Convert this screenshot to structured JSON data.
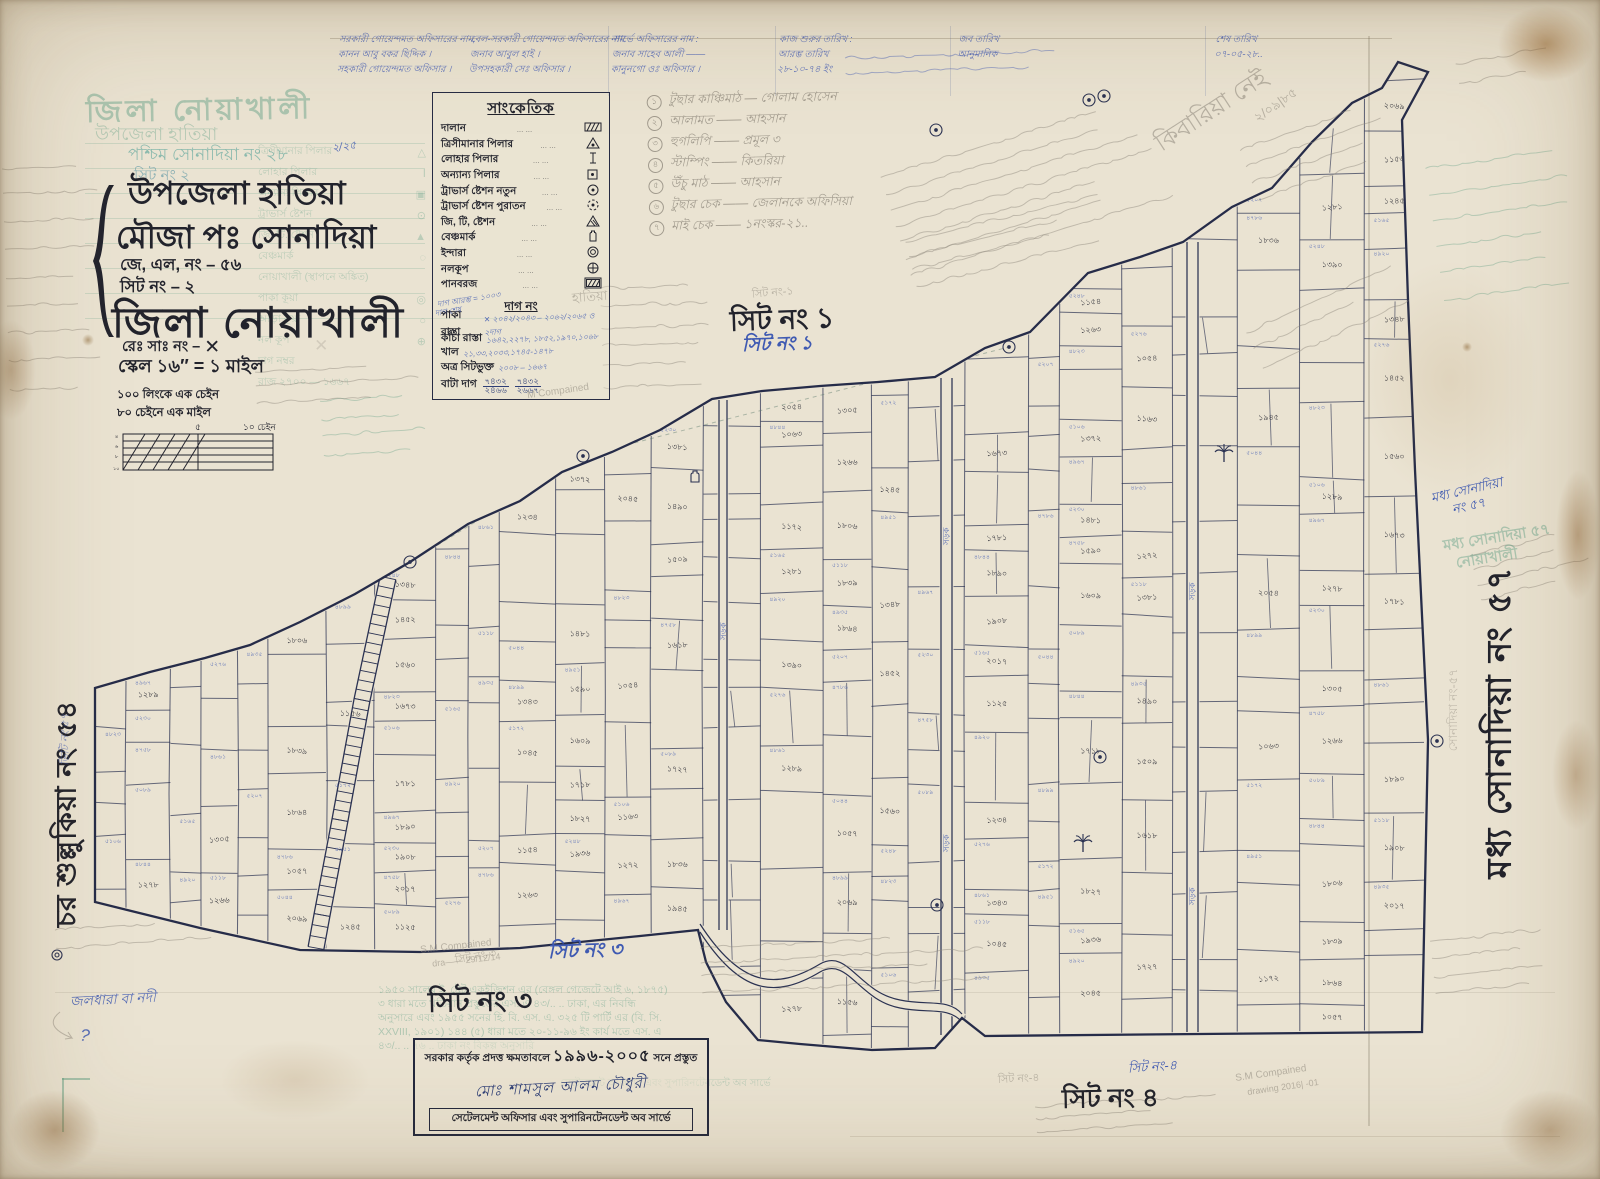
{
  "colors": {
    "paper": "#eae3d2",
    "ink": "#2b3252",
    "black": "#22232c",
    "blue_pen": "#3f5ab2",
    "green_stamp": "#5f9f85",
    "pencil": "#8e887c"
  },
  "title_block": {
    "ghost_district": "জিলা নোয়াখালী",
    "ghost_upazila": "উপজেলা হাতিয়া",
    "ghost_mouza": "পশ্চিম সোনাদিয়া নং ২৮",
    "ghost_sheet": "সিট নং ২",
    "upazila": "উপজেলা হাতিয়া",
    "mouza": "মৌজা  পঃ সোনাদিয়া",
    "jl_no": "জে, এল, নং – ৫৬",
    "sheet_no": "সিট নং – ২",
    "district": "জিলা  নোয়াখালী",
    "reg_no": "রেঃ সাঃ নং –",
    "reg_no_mark": "✕",
    "scale": "স্কেল ১৬″ = ১ মাইল",
    "chain_note1": "১০০ লিংকে এক চেইন",
    "chain_note2": "৮০ চেইনে এক মাইল"
  },
  "scalebar": {
    "mid": "৫",
    "right": "১০ চেইন"
  },
  "legend": {
    "title": "সাংকেতিক",
    "dots": "...      ...",
    "items": [
      {
        "label": "দালান",
        "symbol": "hatched-rect"
      },
      {
        "label": "ত্রিসীমানার পিলার",
        "symbol": "triangle-dot"
      },
      {
        "label": "লোহার পিলার",
        "symbol": "iron-pillar"
      },
      {
        "label": "অন্যান্য পিলার",
        "symbol": "square-dot"
      },
      {
        "label": "ট্রাভার্স ষ্টেশন নতুন",
        "symbol": "circle-dot"
      },
      {
        "label": "ট্রাভার্স ষ্টেশন পুরাতন",
        "symbol": "circle-dashed"
      },
      {
        "label": "জি, টি, ষ্টেশন",
        "symbol": "triangle-hatched"
      },
      {
        "label": "বেঞ্চমার্ক",
        "symbol": "benchmark"
      },
      {
        "label": "ইন্দারা",
        "symbol": "double-circle"
      },
      {
        "label": "নলকূপ",
        "symbol": "circle-cross"
      },
      {
        "label": "পানবরজ",
        "symbol": "hatched-rect-border"
      }
    ],
    "dag_heading": "দাগ নং",
    "dag_rows": [
      {
        "label": "পাকা রাস্তা",
        "value": "✕ ২০৪২/২০৪৩ – ২০৬২/২০৬৫ ও ২দাগ"
      },
      {
        "label": "কাঁচা রাস্তা",
        "value": "১৬৪২,২২৭৮, ১৮৫২,১৯৭০,১০৬৮"
      },
      {
        "label": "খাল",
        "value": "২১,৩৩,২০৩৩,১৭৪৫-১৪৭৮"
      },
      {
        "label": "অত্র সিটভুক্ত",
        "value": "২০০৮ – ১৬৬৭"
      }
    ],
    "bata_label": "বাটা দাগ",
    "bata_fracs": [
      {
        "nu": "৭৪৩২",
        "de": "২৪৬৬"
      },
      {
        "nu": "৭৪৩২",
        "de": "২৬৬৭"
      }
    ],
    "blue_note1": "দাগ আরম্ভ = ১০০৩",
    "blue_note2": "দাগ শেষ"
  },
  "top_table": {
    "columns": [
      {
        "x": 338,
        "lines": [
          "সরকারী গোয়েন্দমত অফিসারের নাম,",
          "কানন আবু বকর ছিদ্দিক ।",
          "সহকারী গোয়েন্দমত অফিসার ।"
        ]
      },
      {
        "x": 470,
        "lines": [
          "বেল-সরকারী গোয়েন্দমত অফিসারের নাম",
          "জনাব আবুল হাই ।",
          "উপসহকারী সেঃ অফিসার ।"
        ]
      },
      {
        "x": 612,
        "lines": [
          "সার্ভে অফিসারের নাম :",
          "জনাব সাহেব আলী ——",
          "কানুনগো ওঃ অফিসার ।"
        ]
      },
      {
        "x": 778,
        "lines": [
          "কাজ শুরুর তারিখ :",
          "আরম্ভ তারিখ",
          "২৮-১০-৭৪ ইং"
        ]
      },
      {
        "x": 958,
        "lines": [
          "",
          "জব তারিখ",
          "আনুমানিক"
        ]
      },
      {
        "x": 1215,
        "lines": [
          "",
          "শেষ তারিখ",
          "০৭-০৫-২৮.."
        ]
      }
    ]
  },
  "numbered_list": {
    "items": [
      "টুছার কাঞ্চিমাঠ — গোলাম হোসেন",
      "আলামত —— আহসান",
      "হুগলিপি —— প্রমূল ৩",
      "স্টাম্পিং —— কিতরিয়া",
      "উঁচু মাঠ —— আহসান",
      "টুছার চেক —— জেলানকে অফিসিয়া",
      "মাই চেক —— ১নংস্কর-২১.."
    ]
  },
  "sheet_labels": {
    "s1_black": "সিট নং ১",
    "s1_blue": "সিট নং ১",
    "s1_pencil": "সিট নং-১",
    "s3_black": "সিট নং ৩",
    "s3_blue": "সিট নং ৩",
    "s4_black": "সিট নং ৪",
    "s4_blue": "সিট নং-৪",
    "s4_pencil": "সিট নং-৪"
  },
  "margins": {
    "left_black": "চর শুল্লুকিয়া নং ৫৪",
    "left_blue": "ভিটি নং ৫৭",
    "right_black": "মধ্য সোনাদিয়া নং ৫৭",
    "right_blue1": "মধ্য সোনাদিয়া",
    "right_blue2": "নং ৫৭",
    "right_green1": "মধ্য সোনাদিয়া ৫৭",
    "right_green2": "নোয়াখালী",
    "right_pencil": "সোনাদিয়া নং-৫৭"
  },
  "stamp_box": {
    "line1_pre": "সরকার কর্তৃক প্রদত্ত ক্ষমতাবলে",
    "years": "১৯৯৬-২০০৫",
    "line1_post": "সনে প্রস্তুত",
    "signature": "মোঃ শামসুল আলম  চৌধুরী",
    "line2": "সেটেলমেন্ট অফিসার এবং সুপারিনটেনডেন্ট অব সার্ভে"
  },
  "ghost": {
    "legend_items": [
      {
        "label": "ত্রিসীমানার পিলার",
        "sym": "△"
      },
      {
        "label": "লোহার পিলার",
        "sym": "Ⅰ"
      },
      {
        "label": "অন্যান্য পিলার",
        "sym": "▣"
      },
      {
        "label": "ট্রাভার্স ষ্টেশন",
        "sym": "⊙"
      },
      {
        "label": "জি. টি. ষ্টেশন",
        "sym": "▲"
      },
      {
        "label": "বেঞ্চমার্ক",
        "sym": "◌"
      },
      {
        "label": "নোয়াখালী (স্থাপনে অঙ্কিত)",
        "sym": ""
      },
      {
        "label": "পাকা কূয়া",
        "sym": "◎"
      },
      {
        "label": "আড়া কূয়া",
        "sym": "○"
      },
      {
        "label": "নল কূপ",
        "sym": "⊕"
      },
      {
        "label": "দাগ নম্বর",
        "sym": ""
      },
      {
        "label": "রাজ  ২৭০০ — ১৬৬৭",
        "sym": ""
      }
    ],
    "stamp_paragraph": [
      "১৯৫০ সালের ই. ষ্টেট একুইজিশন এর (বেঙ্গল গেজেটে আই ৬, ১৮৭৫)",
      "৩ ধারা মতে খতিয়ান প্রস্তুতের এস. এ ৪৩/.. .. ঢাকা, এর নিবন্ধি",
      "অনুসারে এবং ১৯৫৫ সনের হি. বি. এস. এ. ৩২৫ টি পার্টি এর (বি. সি.",
      "XXVIII, ১৯০১) ১৪৪ (৫) ধারা মতে ২০-১১-৯৬ ইং কার্য মতে এস. এ",
      "৪৩/.. .. ৭৬ .. ঢাকা নং বিকল্প অনুসারি"
    ],
    "footer_echo": "সেটেলমেন্ট অফিসার এবং সুপারিনটেনডেন্ট অব সার্ভে"
  },
  "map": {
    "road_label": "সড়ক",
    "parcels": {
      "black": [
        "১২৮৯",
        "১২৭৮",
        "১৩০৫",
        "১২৬৬",
        "১৮০৬",
        "১৮৩৯",
        "১৮৬৪",
        "১০৫৭",
        "২০৬৯",
        "১১৫৬",
        "১২৪৫",
        "১৩৪৮",
        "১৪৫২",
        "১৫৬০",
        "১৬৭৩",
        "১৭৮১",
        "১৮৯০",
        "১৯০৮",
        "২০১৭",
        "১১২৫",
        "১২৩৪",
        "১৩৪৩",
        "১০৪৫",
        "১১৫৪",
        "১২৬৩",
        "১৩৭২",
        "১৪৮১",
        "১৫৯০",
        "১৬০৯",
        "১৭১৮",
        "১৮২৭",
        "১৯৩৬",
        "২০৪৫",
        "১০৫৪",
        "১১৬৩",
        "১২৭২",
        "১৩৮১",
        "১৪৯০",
        "১৫০৯",
        "১৬১৮",
        "১৭২৭",
        "১৮৩৬",
        "১৯৪৫",
        "২০৫৪",
        "১০৬৩",
        "১১৭২",
        "১২৮১",
        "১৩৯০"
      ],
      "blue": [
        "৪৮২৩",
        "৫১০৬",
        "৪৯৬৭",
        "৫২৩০",
        "৪৭৫৮",
        "৫০৮৯",
        "৪৮৪৪",
        "৫১৬৫",
        "৪৯২০",
        "৫২৭৬",
        "৪৮৬১",
        "৫১১৮",
        "৪৯৩৫",
        "৫২০৭",
        "৪৭৮৬",
        "৫০৪৪",
        "৪৮৯৯",
        "৫১৭২",
        "৪৯৫১",
        "৫২৪৮"
      ]
    }
  },
  "annotations": [
    {
      "text": "কিবারিয়া নেই",
      "x": 1148,
      "y": 92,
      "rot": -33,
      "size": 24,
      "cls": "pencil"
    },
    {
      "text": "২/০৯|৮৫",
      "x": 1252,
      "y": 96,
      "rot": -35,
      "size": 13,
      "cls": "pencil"
    },
    {
      "text": "জলধারা বা নদী",
      "x": 70,
      "y": 988,
      "rot": -3,
      "size": 14,
      "cls": "bluepen"
    },
    {
      "text": "?",
      "x": 80,
      "y": 1026,
      "rot": 8,
      "size": 17,
      "cls": "bluepen"
    },
    {
      "text": "S.M Compained",
      "x": 420,
      "y": 941,
      "rot": -6,
      "size": 10,
      "cls": "pencil"
    },
    {
      "text": "dra——  29/12/14",
      "x": 432,
      "y": 955,
      "rot": -6,
      "size": 9,
      "cls": "pencil"
    },
    {
      "text": "S.M Compained",
      "x": 1235,
      "y": 1068,
      "rot": -8,
      "size": 10,
      "cls": "pencil"
    },
    {
      "text": "drawing  2016| -01",
      "x": 1247,
      "y": 1082,
      "rot": -8,
      "size": 9,
      "cls": "pencil"
    },
    {
      "text": "M Compained",
      "x": 527,
      "y": 386,
      "rot": -8,
      "size": 10,
      "cls": "pencil"
    },
    {
      "text": "২/২৫",
      "x": 332,
      "y": 138,
      "rot": -8,
      "size": 11,
      "cls": "bluepen"
    },
    {
      "text": "হাতিয়া",
      "x": 572,
      "y": 288,
      "rot": -4,
      "size": 13,
      "cls": "pencil"
    },
    {
      "text": "সিট নং-১",
      "x": 752,
      "y": 284,
      "rot": -5,
      "size": 11,
      "cls": "pencil"
    },
    {
      "text": "সিট নং-৩",
      "x": 455,
      "y": 948,
      "rot": -10,
      "size": 11,
      "cls": "pencil"
    }
  ]
}
